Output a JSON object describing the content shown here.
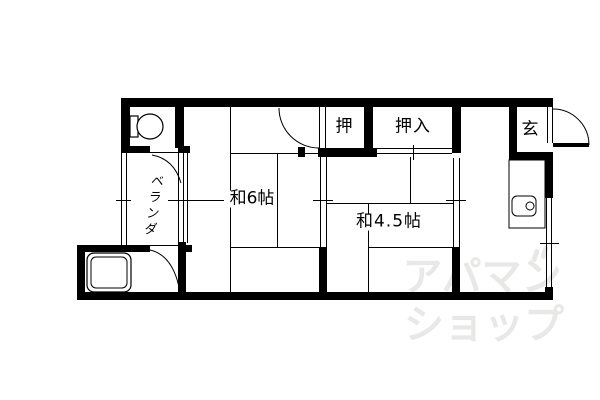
{
  "plan": {
    "type": "floorplan",
    "rooms": {
      "washitsu6": {
        "label": "和6帖"
      },
      "washitsu45": {
        "label": "和4.5帖"
      },
      "closet_small": {
        "label": "押"
      },
      "closet_large": {
        "label": "押入"
      },
      "entrance": {
        "label": "玄"
      },
      "veranda": {
        "label": "ベランダ"
      }
    },
    "fixtures": {
      "toilet": "toilet-icon",
      "bathtub": "bathtub-icon",
      "kitchen_sink": "kitchen-sink-icon",
      "entrance_door": "door-swing-icon"
    },
    "colors": {
      "line": "#000000",
      "background": "#ffffff",
      "watermark": "#e8e8e7"
    }
  },
  "watermark": {
    "line1": "アパマン",
    "line2": "ショップ"
  }
}
